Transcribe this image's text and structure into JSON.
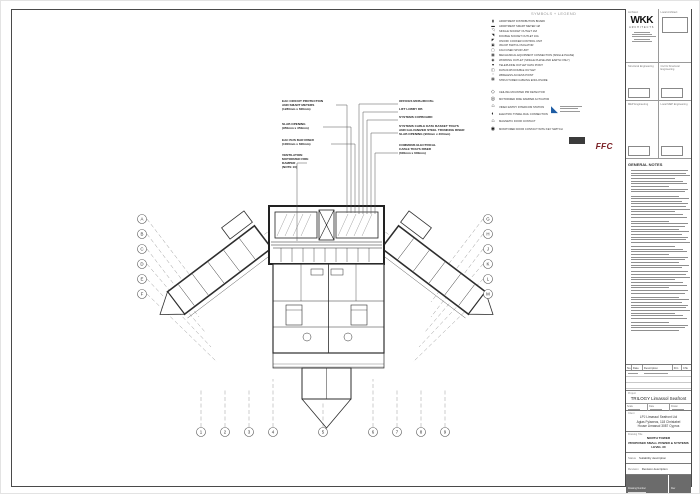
{
  "page": {
    "accent_blue": "#1c5ba3",
    "ffc_red": "#7a1f24",
    "line": "#2e2e2e"
  },
  "legend": {
    "title": "SYMBOLS + LEGEND",
    "groups": [
      {
        "items": [
          {
            "icon": "▮",
            "label": "APARTMENT DISTRIBUTION BOARD"
          },
          {
            "icon": "▬",
            "label": "APARTMENT SMART METER 1Ø"
          },
          {
            "icon": "◹",
            "label": "SINGLE SOCKET OUTLET 16A"
          },
          {
            "icon": "◥",
            "label": "DOUBLE SOCKET OUTLET 16A"
          },
          {
            "icon": "◤",
            "label": "ON/OFF COOKER CONTROL UNIT"
          },
          {
            "icon": "▣",
            "label": "45A DP SWITCH ISOLATOR"
          },
          {
            "icon": "▢",
            "label": "16A FUSED SPUR UNIT"
          },
          {
            "icon": "▦",
            "label": "MECHANICAL EQUIPMENT CONNECTION (SINGLE PHASE)"
          },
          {
            "icon": "◉",
            "label": "WORKING OUTLET (SINGLE PHASE AND EARTH ONLY)"
          },
          {
            "icon": "▼",
            "label": "TELEPHONE OUTLET DATA POINT"
          },
          {
            "icon": "◫",
            "label": "DATA RJ45 DOUBLE OUTLET"
          },
          {
            "icon": "▫",
            "label": "WIRELESS ACCESS POINT"
          },
          {
            "icon": "▩",
            "label": "STRUCTURED CABLING ENCLOSURE"
          }
        ]
      },
      {
        "items": [
          {
            "icon": "◇",
            "label": "CEILING MOUNTED PIR DETECTOR"
          },
          {
            "icon": "◎",
            "label": "MOTORIZED FIRE DAMPER ACTUATOR"
          },
          {
            "icon": "⌂",
            "label": "VIDEO ENTRY INTERCOM STATION"
          },
          {
            "icon": "◐",
            "label": "ELECTRIC TOWEL RAIL CONNECTION"
          },
          {
            "icon": "⌂",
            "label": "MAGNETIC DOOR CONTACT"
          },
          {
            "icon": "◉",
            "label": "MONITORED DOOR CONTACT WITH KEY SWITCH"
          }
        ]
      }
    ]
  },
  "callouts": {
    "left": [
      {
        "lines": [
          "EAC CIRCUIT PROTECTION",
          "AND SMART METERS",
          "(1280mm x 600mm)"
        ]
      },
      {
        "lines": [
          "SLAB OPENING",
          "(950mm x 350mm)"
        ]
      },
      {
        "lines": [
          "EAC BUS BAR RISER",
          "(1000mm x 600mm)"
        ]
      },
      {
        "lines": [
          "VENTILATION",
          "MOTORIZED FIRE",
          "DAMPER",
          "(NOTE 10)"
        ]
      }
    ],
    "right": [
      {
        "lines": [
          "OFFICES MCBs/RCCBs"
        ]
      },
      {
        "lines": [
          "LIFT LOBBY DB"
        ]
      },
      {
        "lines": [
          "SYSTEMS CUPBOARD"
        ]
      },
      {
        "lines": [
          "SYSTEMS CABLE DATA BASKET TRAYS",
          "AND GALVANIZED STEEL TRUNKING RISER",
          "SLAB OPENING (900mm x 400mm)"
        ]
      },
      {
        "lines": [
          "COMMONS ELECTRICAL",
          "CABLE TRAYS RISER",
          "(600mm x 600mm)"
        ]
      }
    ]
  },
  "logos": {
    "ffc": "FFC"
  },
  "titleblock": {
    "architect_logo": "WKK",
    "architect_sub": "ARCHITECTS",
    "cells": [
      {
        "label": "Architect"
      },
      {
        "label": "Local Architect"
      },
      {
        "label": "Structural Engineering"
      },
      {
        "label": "Civil & Structural Engineering"
      },
      {
        "label": "MEP Engineering"
      },
      {
        "label": "Local MEP Engineering"
      }
    ],
    "notes_title": "GENERAL NOTES",
    "rev_headers": [
      "No.",
      "Date",
      "Description",
      "Drn",
      "Chk"
    ],
    "project_label": "Project",
    "project_name": "TRILOGY Limassol Seafront",
    "meta_labels": [
      "Scale",
      "Date",
      "Drawn"
    ],
    "client_label": "Client",
    "client_lines": [
      "LPJ Limassol Seafront Ltd",
      "Agias Fylaxeos, 118 Christabel",
      "House Limassol 3087 Cyprus"
    ],
    "title_label": "Drawing Title",
    "title_lines": [
      "NORTH TOWER",
      "PROPOSED SMALL POWER & SYSTEMS",
      "LEVEL 30"
    ],
    "status_label": "Status",
    "status_value": "Suitability description",
    "revision_label": "Revision",
    "revision_value": "Revision description",
    "footer_labels": [
      "Drawing Number",
      "Rev"
    ]
  },
  "grid": {
    "left": [
      "A",
      "B",
      "C",
      "D",
      "E",
      "F"
    ],
    "right": [
      "G",
      "H",
      "J",
      "K",
      "L",
      "M"
    ],
    "bottom": [
      "1",
      "2",
      "3",
      "4",
      "5",
      "6",
      "7",
      "8",
      "9"
    ]
  }
}
